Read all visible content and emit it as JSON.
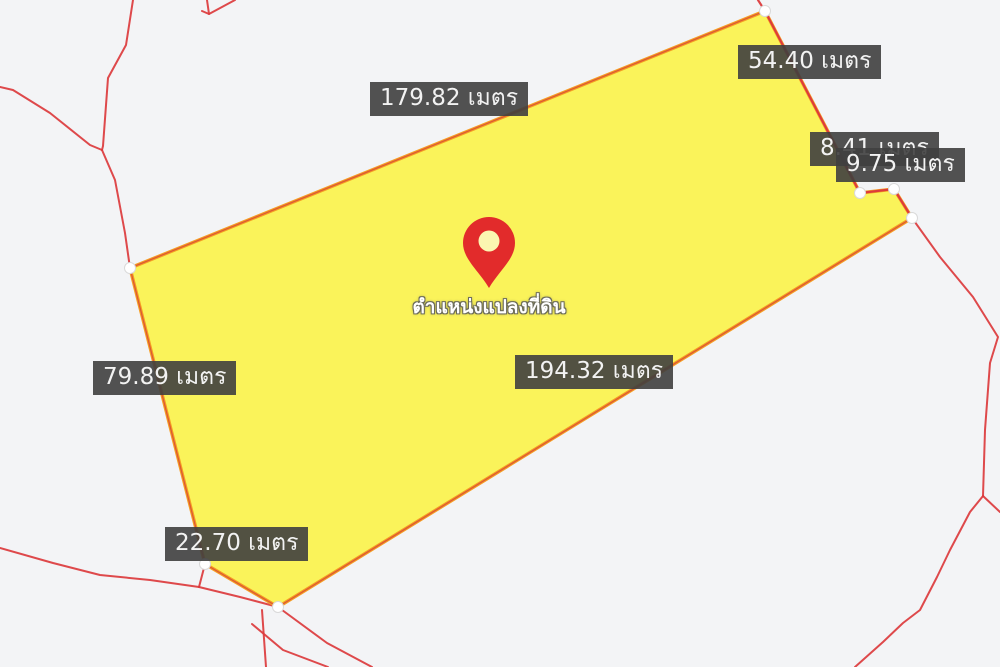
{
  "map": {
    "background_color": "#f3f4f6",
    "boundary_line_color": "#dc3a3c",
    "vertex_dot_color": "#ffffff",
    "parcel": {
      "fill_color": "#fbf24c",
      "border_color": "#f59e23",
      "edge_overlay_color": "#d4423a",
      "vertices": [
        [
          130,
          268
        ],
        [
          765,
          11
        ],
        [
          860,
          193
        ],
        [
          894,
          189
        ],
        [
          912,
          218
        ],
        [
          278,
          607
        ],
        [
          205,
          564
        ]
      ]
    },
    "marker": {
      "color": "#e22b2b",
      "hole_color": "#fbf6b1",
      "x": 489,
      "tip_y": 288,
      "label": "ตำแหน่งแปลงที่ดิน"
    },
    "boundary_lines": [
      [
        [
          133,
          0
        ],
        [
          126,
          45
        ],
        [
          108,
          78
        ],
        [
          103,
          146
        ],
        [
          102,
          150
        ]
      ],
      [
        [
          0,
          87
        ],
        [
          13,
          90
        ],
        [
          50,
          113
        ],
        [
          90,
          145
        ],
        [
          102,
          150
        ]
      ],
      [
        [
          102,
          150
        ],
        [
          115,
          180
        ],
        [
          125,
          233
        ],
        [
          130,
          268
        ]
      ],
      [
        [
          202,
          11
        ],
        [
          209,
          14
        ],
        [
          207,
          0
        ]
      ],
      [
        [
          209,
          14
        ],
        [
          235,
          0
        ]
      ],
      [
        [
          0,
          548
        ],
        [
          53,
          563
        ],
        [
          100,
          575
        ],
        [
          150,
          580
        ],
        [
          199,
          587
        ]
      ],
      [
        [
          199,
          587
        ],
        [
          205,
          564
        ]
      ],
      [
        [
          199,
          587
        ],
        [
          240,
          597
        ],
        [
          278,
          607
        ]
      ],
      [
        [
          278,
          607
        ],
        [
          327,
          643
        ],
        [
          372,
          667
        ]
      ],
      [
        [
          262,
          610
        ],
        [
          266,
          667
        ]
      ],
      [
        [
          252,
          624
        ],
        [
          283,
          650
        ],
        [
          328,
          667
        ]
      ],
      [
        [
          912,
          218
        ],
        [
          940,
          257
        ],
        [
          973,
          297
        ],
        [
          998,
          337
        ],
        [
          990,
          363
        ],
        [
          985,
          430
        ],
        [
          983,
          496
        ]
      ],
      [
        [
          983,
          496
        ],
        [
          1000,
          512
        ]
      ],
      [
        [
          983,
          496
        ],
        [
          970,
          512
        ],
        [
          950,
          550
        ],
        [
          937,
          577
        ],
        [
          920,
          610
        ],
        [
          903,
          623
        ],
        [
          883,
          642
        ],
        [
          855,
          667
        ]
      ]
    ],
    "overlay_lines": [
      [
        [
          758,
          0
        ],
        [
          765,
          11
        ],
        [
          860,
          193
        ],
        [
          894,
          189
        ],
        [
          912,
          218
        ]
      ]
    ],
    "measurements": [
      {
        "text": "179.82 เมตร",
        "x": 370,
        "y": 82
      },
      {
        "text": "54.40 เมตร",
        "x": 738,
        "y": 45
      },
      {
        "text": "8.41 เมตร",
        "x": 810,
        "y": 132
      },
      {
        "text": "9.75 เมตร",
        "x": 836,
        "y": 148
      },
      {
        "text": "79.89 เมตร",
        "x": 93,
        "y": 361
      },
      {
        "text": "194.32 เมตร",
        "x": 515,
        "y": 355
      },
      {
        "text": "22.70 เมตร",
        "x": 165,
        "y": 527
      }
    ]
  }
}
